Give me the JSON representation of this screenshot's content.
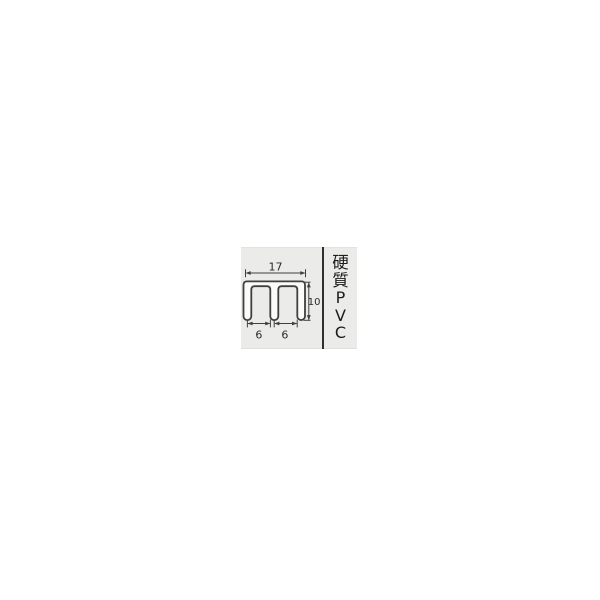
{
  "page": {
    "background_color": "#ffffff"
  },
  "panel": {
    "background_color": "#ebebe9",
    "divider_color": "#2e2e2e"
  },
  "diagram": {
    "description": "Cross-section of rigid PVC double-channel (E-shaped) profile with dimension lines",
    "outline_color": "#404040",
    "shape_fill_color": "#fbfbf9",
    "dimension_text_color": "#2a2a2a",
    "dimensions": {
      "overall_width": "17",
      "overall_height": "10",
      "left_channel_width": "6",
      "right_channel_width": "6"
    }
  },
  "material_label": {
    "text": "硬質PVC",
    "characters": [
      "硬",
      "質",
      "P",
      "V",
      "C"
    ],
    "orientation": "vertical",
    "color": "#1c1c1c"
  }
}
